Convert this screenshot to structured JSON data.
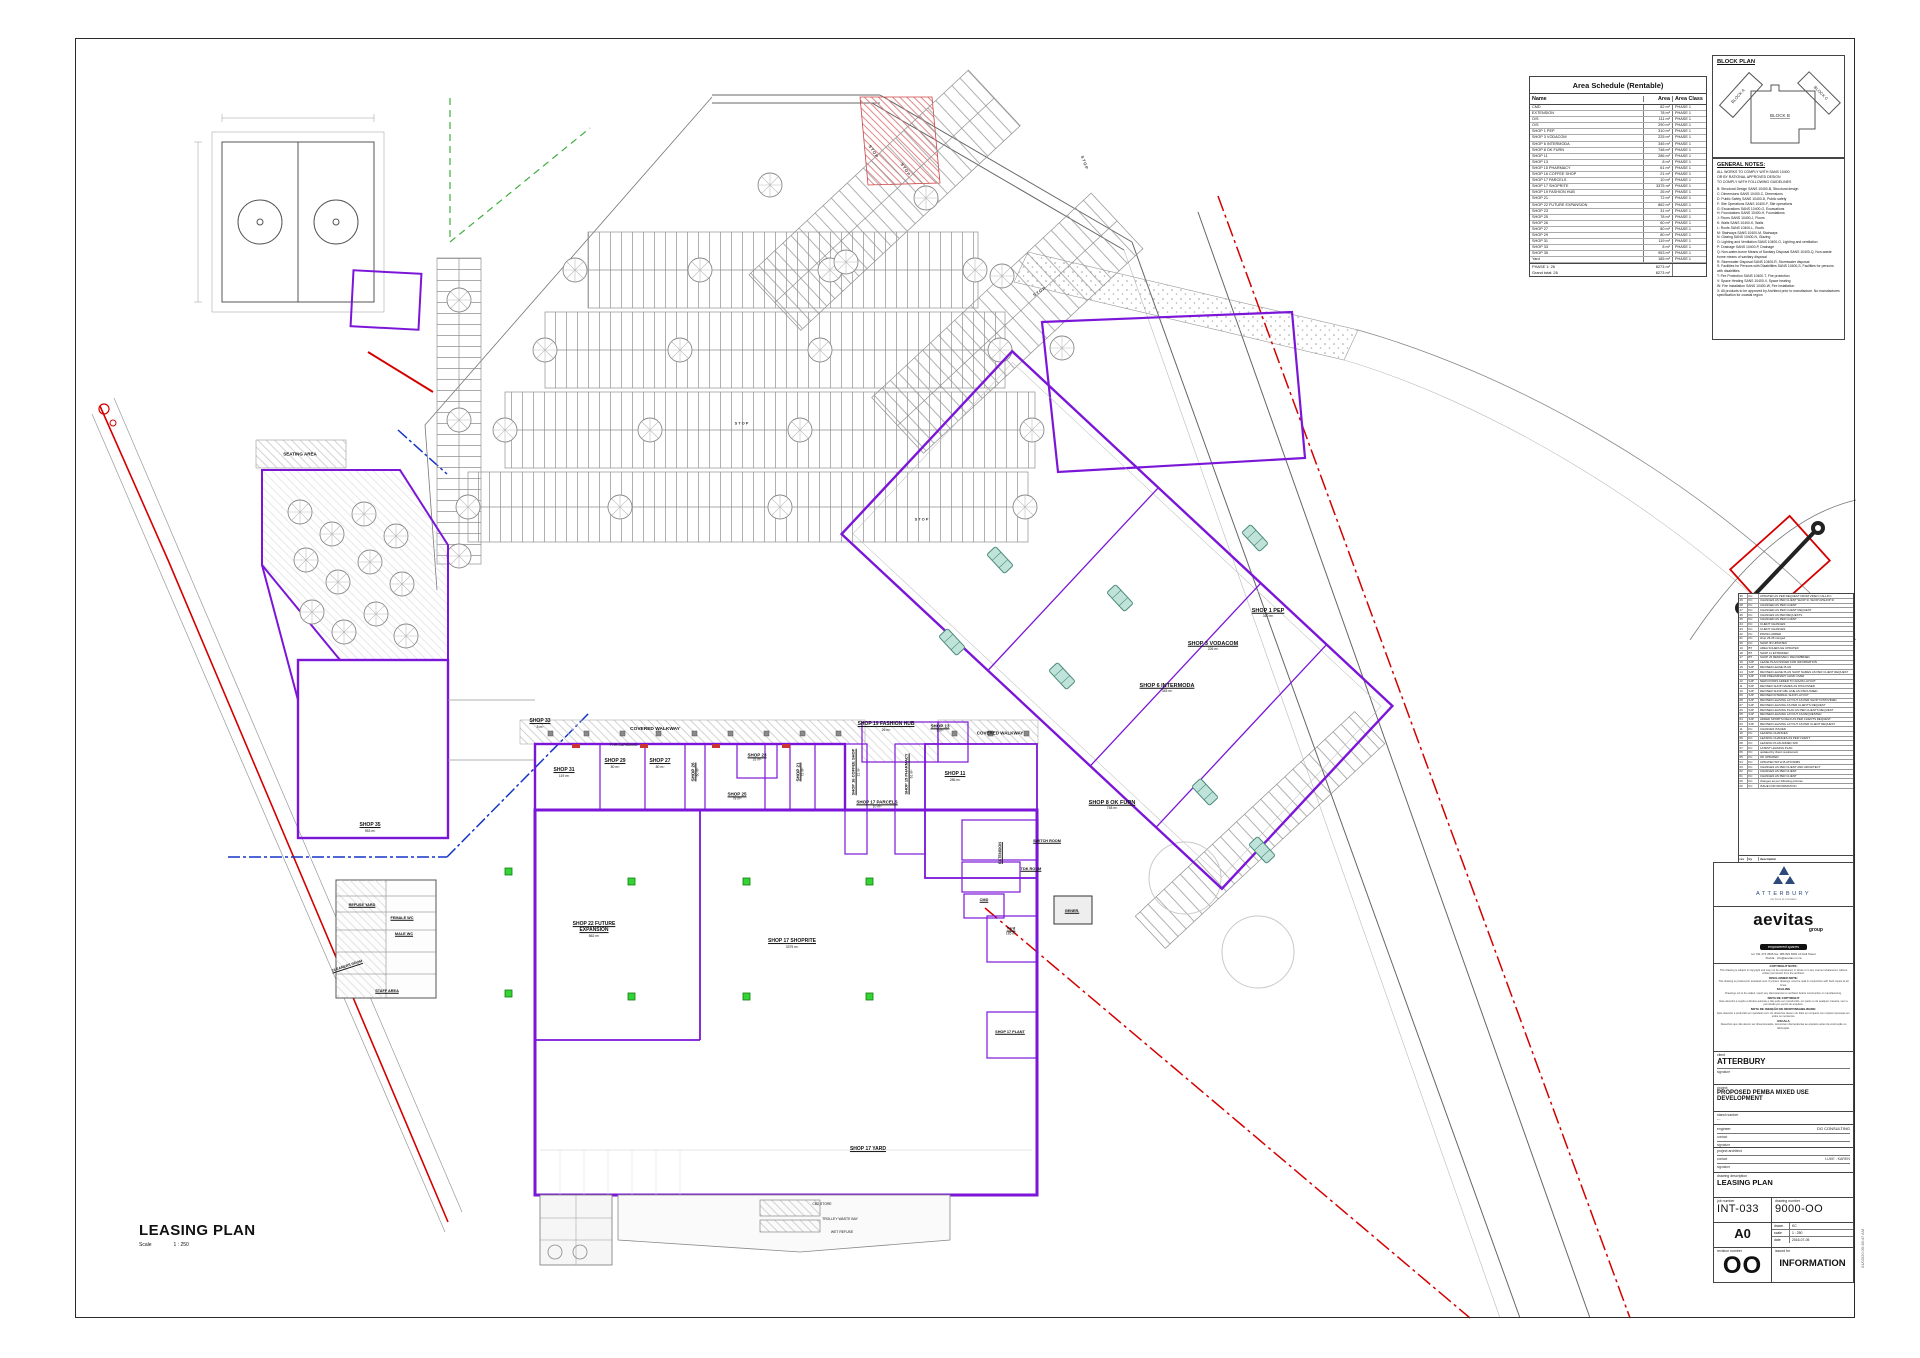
{
  "page": {
    "title": "LEASING PLAN",
    "scale_label": "Scale",
    "scale_value": "1 : 250",
    "print_stamp": "01/03/20 09:38:47 AM"
  },
  "area_schedule": {
    "title": "Area Schedule (Rentable)",
    "columns": [
      "Name",
      "Area",
      "Area Class"
    ],
    "rows": [
      {
        "name": "CMD",
        "area": "82 m²",
        "class": "PHASE 1"
      },
      {
        "name": "EXTENSION",
        "area": "78 m²",
        "class": "PHASE 1"
      },
      {
        "name": "O/S",
        "area": "111 m²",
        "class": "PHASE 1"
      },
      {
        "name": "O/S",
        "area": "290 m²",
        "class": "PHASE 1"
      },
      {
        "name": "SHOP 1 PEP",
        "area": "310 m²",
        "class": "PHASE 1"
      },
      {
        "name": "SHOP 3 VODACOM",
        "area": "225 m²",
        "class": "PHASE 1"
      },
      {
        "name": "SHOP 6 INTERMODA",
        "area": "345 m²",
        "class": "PHASE 1"
      },
      {
        "name": "SHOP 8 OK FURN",
        "area": "748 m²",
        "class": "PHASE 1"
      },
      {
        "name": "SHOP 11",
        "area": "286 m²",
        "class": "PHASE 1"
      },
      {
        "name": "SHOP 13",
        "area": "8 m²",
        "class": "PHASE 1"
      },
      {
        "name": "SHOP 15 PHARMACY",
        "area": "61 m²",
        "class": "PHASE 1"
      },
      {
        "name": "SHOP 16 COFFEE SHOP",
        "area": "21 m²",
        "class": "PHASE 1"
      },
      {
        "name": "SHOP 17 PARCELS",
        "area": "10 m²",
        "class": "PHASE 1"
      },
      {
        "name": "SHOP 17 SHOPRITE",
        "area": "3375 m²",
        "class": "PHASE 1"
      },
      {
        "name": "SHOP 19 FASHION HUB",
        "area": "26 m²",
        "class": "PHASE 1"
      },
      {
        "name": "SHOP 21",
        "area": "72 m²",
        "class": "PHASE 1"
      },
      {
        "name": "SHOP 22 FUTURE EXPANSION",
        "area": "862 m²",
        "class": "PHASE 1"
      },
      {
        "name": "SHOP 23",
        "area": "31 m²",
        "class": "PHASE 1"
      },
      {
        "name": "SHOP 25",
        "area": "78 m²",
        "class": "PHASE 1"
      },
      {
        "name": "SHOP 26",
        "area": "60 m²",
        "class": "PHASE 1"
      },
      {
        "name": "SHOP 27",
        "area": "80 m²",
        "class": "PHASE 1"
      },
      {
        "name": "SHOP 29",
        "area": "80 m²",
        "class": "PHASE 1"
      },
      {
        "name": "SHOP 31",
        "area": "119 m²",
        "class": "PHASE 1"
      },
      {
        "name": "SHOP 33",
        "area": "8 m²",
        "class": "PHASE 1"
      },
      {
        "name": "SHOP 35",
        "area": "953 m²",
        "class": "PHASE 1"
      },
      {
        "name": "Yard",
        "area": "185 m²",
        "class": "PHASE 1"
      }
    ],
    "totals": [
      {
        "label": "PHASE 1: 26",
        "value": "8273 m²"
      },
      {
        "label": "Grand total: 26",
        "value": "8273 m²"
      }
    ]
  },
  "block_plan": {
    "title": "BLOCK PLAN",
    "blocks": [
      "BLOCK A",
      "BLOCK B",
      "BLOCK C"
    ]
  },
  "general_notes": {
    "title": "GENERAL NOTES:",
    "intro": [
      "ALL WORKS TO COMPLY WITH SANS 10400",
      "OR BY RATIONAL APPROVED DESIGN",
      "TO COMPLY WITH FOLLOWING GUIDELINES"
    ],
    "items": [
      "B: Structural Design SANS 10400-B, Structural design",
      "C: Dimensions SANS 10400-C, Dimensions",
      "D: Public Safety SANS 10400-D, Public safety",
      "F: Site Operations SANS 10400-F, Site operations",
      "G: Excavations SANS 10400-G, Excavations",
      "H: Foundations SANS 10400-H, Foundations",
      "J: Floors SANS 10400-J, Floors",
      "K: Walls SANS 10400-K, Walls",
      "L: Roofs SANS 10400-L, Roofs",
      "M: Stairways SANS 10400-M, Stairways",
      "N: Glazing SANS 10400-N, Glazing",
      "O: Lighting and Ventilation SANS 10400-O, Lighting and ventilation",
      "P: Drainage SANS 10400-P, Drainage",
      "Q: Non-water-borne Means of Sanitary Disposal SANS 10400-Q, Non-waste borne means of sanitary disposal",
      "R: Stormwater Disposal SANS 10400-R, Stormwater disposal",
      "S: Facilities for Persons with Disabilities SANS 10400-S, Facilities for persons with disabilities",
      "T: Fire Protection SANS 10400-T, Fire protection",
      "V: Space Heating SANS 10400-V, Space heating",
      "W: Fire Installation SANS 10400-W, Fire installation",
      "X: All products to be approved by Architect prior to manufacture. No manufactures specification for coastal region"
    ]
  },
  "revisions": {
    "columns": [
      "rev",
      "by",
      "description"
    ],
    "rows": [
      {
        "rev": "30",
        "by": "KC",
        "desc": "UPDATED AS PER REQUEST FROM VIDEO CALL/KC"
      },
      {
        "rev": "29",
        "by": "KC",
        "desc": "CHANGES AS PER CLIENT SHOP 3I, SHOP 2I/SHOP 3I"
      },
      {
        "rev": "28",
        "by": "KC",
        "desc": "CHANGED AS PER CLIENT"
      },
      {
        "rev": "27",
        "by": "KC",
        "desc": "CHANGED AS PER CLIENT REQUEST"
      },
      {
        "rev": "26",
        "by": "KC",
        "desc": "CHANGES AS PER REQUESTS"
      },
      {
        "rev": "25",
        "by": "KC",
        "desc": "CHANGED AS PER CLIENT"
      },
      {
        "rev": "24",
        "by": "KC",
        "desc": "CLIENT CHANGES"
      },
      {
        "rev": "23",
        "by": "KC",
        "desc": "CLIENT CHANGES"
      },
      {
        "rev": "22",
        "by": "KC",
        "desc": "PAVING ADDED"
      },
      {
        "rev": "21",
        "by": "KC",
        "desc": "shop 23-26 merged"
      },
      {
        "rev": "20",
        "by": "KC",
        "desc": "SHOP 3N UPDATES"
      },
      {
        "rev": "19",
        "by": "BT",
        "desc": "AREA SCHEDULE UPDATED"
      },
      {
        "rev": "18",
        "by": "BT",
        "desc": "SHOP 11 EXTENDED"
      },
      {
        "rev": "17",
        "by": "BT",
        "desc": "SHOP 23 REMOVED / RECOMBINED"
      },
      {
        "rev": "16",
        "by": "SJP",
        "desc": "LEASE PLAN ISSUED FOR INFORMATION"
      },
      {
        "rev": "15",
        "by": "SJP",
        "desc": "REVISED LEASE PLAN"
      },
      {
        "rev": "14",
        "by": "SJP",
        "desc": "REVISED LEASE PLAN SHOP NAMES AS PER CLIENT REQUEST"
      },
      {
        "rev": "13",
        "by": "SJP",
        "desc": "FOR PRELIMINARY HAND OVER"
      },
      {
        "rev": "12",
        "by": "SJP",
        "desc": "NEW DOORS ADDED TO 22A/26 LAYOUT"
      },
      {
        "rev": "11",
        "by": "SJP",
        "desc": "REVISED SHOP NAMES AS DISCUSSED"
      },
      {
        "rev": "10",
        "by": "SJP",
        "desc": "REVISED SHOP GBL LINE AS DISCUSSED"
      },
      {
        "rev": "09",
        "by": "SJP",
        "desc": "REVISED INTERNAL SHOP LAYOUT"
      },
      {
        "rev": "08",
        "by": "SJP",
        "desc": "REVISED LEASING LAYOUT AS PER SHOP 6 PROVIDED"
      },
      {
        "rev": "07",
        "by": "SJP",
        "desc": "REVISED LEASING AS PER CLIENT'S REQUEST"
      },
      {
        "rev": "06",
        "by": "SJP",
        "desc": "REVISED LEASING PLAN AS PER CLIENTS REQUEST"
      },
      {
        "rev": "05",
        "by": "SJP",
        "desc": "REVISED LEASING LAYOUT AS REQUESTED"
      },
      {
        "rev": "04",
        "by": "SJP",
        "desc": "ADDED SPORTS FIELD AS PER CLIENTS REQUEST"
      },
      {
        "rev": "03",
        "by": "SJP",
        "desc": "REVISED LEASING LAYOUT AS PER CLIENT REQUEST"
      },
      {
        "rev": "11",
        "by": "KC",
        "desc": "CHANGES ISSUED"
      },
      {
        "rev": "10",
        "by": "KC",
        "desc": "LEASING CHANGES"
      },
      {
        "rev": "09",
        "by": "KC",
        "desc": "LEASING CHANGES AS PER CLIENT"
      },
      {
        "rev": "08",
        "by": "KC",
        "desc": "LEASING PLAN ADDED S/W"
      },
      {
        "rev": "07",
        "by": "KC",
        "desc": "LATEST LEASING PLAN"
      },
      {
        "rev": "06",
        "by": "KC",
        "desc": "updated by client requirement"
      },
      {
        "rev": "05",
        "by": "KC",
        "desc": "OK UPDATED"
      },
      {
        "rev": "04",
        "by": "KC",
        "desc": "UPDATED WITH PLATFORMS"
      },
      {
        "rev": "03",
        "by": "KC",
        "desc": "CHANGES AS PER CLIENT AND ARCHITECT"
      },
      {
        "rev": "02",
        "by": "KC",
        "desc": "CHANGES AS PER CLIENT"
      },
      {
        "rev": "01",
        "by": "KC",
        "desc": "CHANGES AS PER CLIENT"
      },
      {
        "rev": "00",
        "by": "KC",
        "desc": "changes as per following pictures"
      },
      {
        "rev": "00",
        "by": "KC",
        "desc": "ISSUE FOR INFORMATION"
      }
    ]
  },
  "titleblock": {
    "attlogo_name": "ATTERBURY",
    "attlogo_tagline": "the home of innovation",
    "brand": {
      "name": "aevitas",
      "group": "group",
      "tagline": "empowered spaces",
      "contact_line1": "tel: 011 472 3606   fax: 086 822 8181   10 Hull Street",
      "contact_line2": "Florida · info@aevitas.co.za"
    },
    "notes": {
      "copyright_title": "COPYRIGHT NOTE:",
      "copyright_body": "This drawing is subject to copyright and may not be reproduced, in whole or in any manner whatsoever, without written permission from the architect.",
      "disclaimer_title": "DISCLAIMER NOTE:",
      "disclaimer_body": "This drawing is produced in autodesk revit. If printed, drawings must be read in conjunction with hard copies at all times.",
      "scaling_title": "SCALING",
      "scaling_body": "Drawings not to be scaled, report any discrepancies to architect before construction or manufacturing.",
      "pt_copyright_title": "NOTA DE COPYRIGHT",
      "pt_copyright_body": "Este desenho é sujeito a direitos autorais e não pode ser reproduzido, em parte ou de qualquer maneira, sem a permissão por escrito do arquiteto.",
      "pt_disclaimer_title": "NOTA DE ISENÇÃO DE RESPONSABILIDADE:",
      "pt_disclaimer_body": "Este desenho é produzido em autodesk revit. Os desenhos devem ser lidos em conjunto com cópias impressas em todos os momentos.",
      "pt_scale_title": "ESCALA",
      "pt_scale_body": "Desenhos que não devem ser dimensionados, denunciam discrepâncias ao arquiteto antes da construção ou fabricação."
    },
    "client_label": "client",
    "client": "ATTERBURY",
    "signature_label": "signature",
    "project_label": "project",
    "project": "PROPOSED PEMBA MIXED USE DEVELOPMENT",
    "stand_label": "stand number",
    "stand": "---",
    "engineer_label": "engineer",
    "engineer": "DG CONSULTING",
    "contact_label": "contact",
    "architect_label": "project architect",
    "architect_contact": "LUKE : KAREN",
    "drawing_description_label": "drawing description",
    "drawing_description": "LEASING PLAN",
    "job_number_label": "job number",
    "job_number": "INT-033",
    "drawing_number_label": "drawing number",
    "drawing_number": "9000-OO",
    "sheet_size": "A0",
    "drawn_label": "drawn",
    "drawn": "KC",
    "scale_label": "scale",
    "scale": "1 : 250",
    "date_label": "date",
    "date": "2016-07-05",
    "revision_label": "revision number",
    "revision": "OO",
    "issued_label": "issued for",
    "issued": "INFORMATION"
  },
  "plan": {
    "labels": {
      "seating": "SEATING AREA",
      "walkway": "COVERED WALKWAY",
      "stop": "STOP",
      "shop33": {
        "name": "SHOP 33",
        "area": "8 m²"
      },
      "fashion": {
        "name": "SHOP 19 FASHION HUB",
        "area": "26 m²"
      },
      "shop13": {
        "name": "SHOP 13",
        "area": "8 m²"
      },
      "shop31": {
        "name": "SHOP 31",
        "area": "119 m²"
      },
      "shop29": {
        "name": "SHOP 29",
        "area": "80 m²"
      },
      "shop27": {
        "name": "SHOP 27",
        "area": "80 m²"
      },
      "shop26": {
        "name": "SHOP 26",
        "area": "60 m²"
      },
      "shop23": {
        "name": "SHOP 23",
        "area": "31 m²"
      },
      "shop25": {
        "name": "SHOP 25",
        "area": "78 m²"
      },
      "shop21": {
        "name": "SHOP 21",
        "area": "72 m²"
      },
      "coffee": {
        "name": "SHOP 16 COFFEE SHOP",
        "area": "21 m²"
      },
      "pharmacy": {
        "name": "SHOP 15 PHARMACY",
        "area": "61 m²"
      },
      "shop11": {
        "name": "SHOP 11",
        "area": "286 m²"
      },
      "parcels": {
        "name": "SHOP 17 PARCELS",
        "area": "10 m²"
      },
      "shop35": {
        "name": "SHOP 35",
        "area": "953 m²"
      },
      "shop22": {
        "name": "SHOP 22 FUTURE EXPANSION",
        "area": "862 m²"
      },
      "shoprite": {
        "name": "SHOP 17 SHOPRITE",
        "area": "3375 m²"
      },
      "pep": {
        "name": "SHOP 1 PEP",
        "area": "310 m²"
      },
      "vodacom": {
        "name": "SHOP 3 VODACOM",
        "area": "226 m²"
      },
      "intermoda": {
        "name": "SHOP 6 INTERMODA",
        "area": "345 m²"
      },
      "okfurn": {
        "name": "SHOP 8 OK FURN",
        "area": "748 m²"
      },
      "switch_room": "SWITCH ROOM",
      "tdk_room": "TDK ROOM",
      "cmd": "CMD",
      "generator": "GENER.",
      "yard": {
        "name": "Yard",
        "area": "185 m²"
      },
      "plant": "SHOP 17 PLANT",
      "yard17": "SHOP 17 YARD",
      "refuse": "REFUSE YARD",
      "female_wc": "FEMALE WC",
      "male_wc": "MALE WC",
      "cleaners": "CLEANERS ROOM",
      "staff": "STAFF AREA",
      "extension": "EXTENSION",
      "fhr": "FHR CUPBOARD",
      "cbz": "CBZ STORE",
      "trolley": "TROLLEY WASTE BAY",
      "wet": "WET REFUSE"
    }
  }
}
